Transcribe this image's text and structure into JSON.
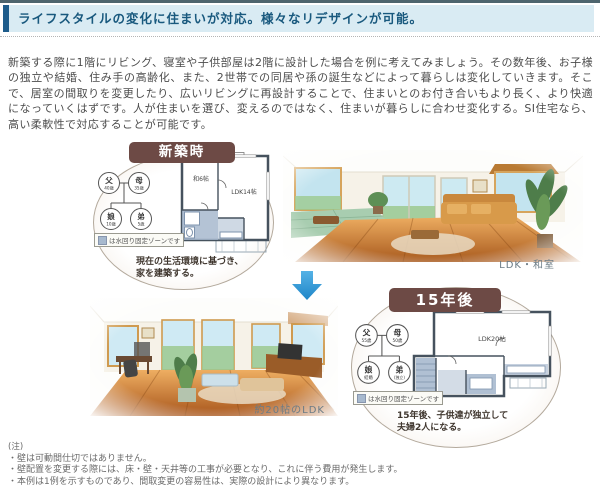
{
  "header": {
    "title": "ライフスタイルの変化に住まいが対応。様々なリデザインが可能。"
  },
  "intro": {
    "text": "新築する際に1階にリビング、寝室や子供部屋は2階に設計した場合を例に考えてみましょう。その数年後、お子様の独立や結婚、住み手の高齢化、また、2世帯での同居や孫の誕生などによって暮らしは変化していきます。そこで、居室の間取りを変更したり、広いリビングに再設計することで、住まいとのお付き合いもより長く、より快適になっていくはずです。人が住まいを選び、変えるのではなく、住まいが暮らしに合わせ変化する。SI住宅なら、高い柔軟性で対応することが可能です。"
  },
  "before": {
    "badge": "新築時",
    "family": {
      "father": {
        "name": "父",
        "age": "40歳"
      },
      "mother": {
        "name": "母",
        "age": "35歳"
      },
      "daughter": {
        "name": "娘",
        "age": "10歳"
      },
      "son": {
        "name": "弟",
        "age": "5歳"
      }
    },
    "legend": "は水回り固定ゾーンです",
    "plan": {
      "room1": "和6帖",
      "room2": "LDK14帖"
    },
    "caption": "現在の生活環境に基づき、\n家を建築する。"
  },
  "after": {
    "badge": "15年後",
    "family": {
      "father": {
        "name": "父",
        "age": "55歳"
      },
      "mother": {
        "name": "母",
        "age": "50歳"
      },
      "daughter": {
        "name": "娘",
        "age": "結婚"
      },
      "son": {
        "name": "弟",
        "age": "(独立)"
      }
    },
    "legend": "は水回り固定ゾーンです",
    "plan": {
      "room1": "LDK20帖"
    },
    "caption": "15年後、子供達が独立して\n夫婦2人になる。"
  },
  "photos": {
    "photo1_caption": "LDK・和室",
    "photo2_caption": "約20帖のLDK"
  },
  "notes": {
    "label": "(注)",
    "items": [
      "・壁は可動間仕切ではありません。",
      "・壁配置を変更する際には、床・壁・天井等の工事が必要となり、これに伴う費用が発生します。",
      "・本例は1例を示すものであり、間取変更の容易性は、実際の設計により異なります。"
    ]
  },
  "colors": {
    "accent_blue": "#1e5c8b",
    "header_bg": "#d9ebf3",
    "badge_brown": "#6d4a45",
    "arrow_blue": "#2f9ada",
    "water_zone": "#a7b9ce"
  }
}
